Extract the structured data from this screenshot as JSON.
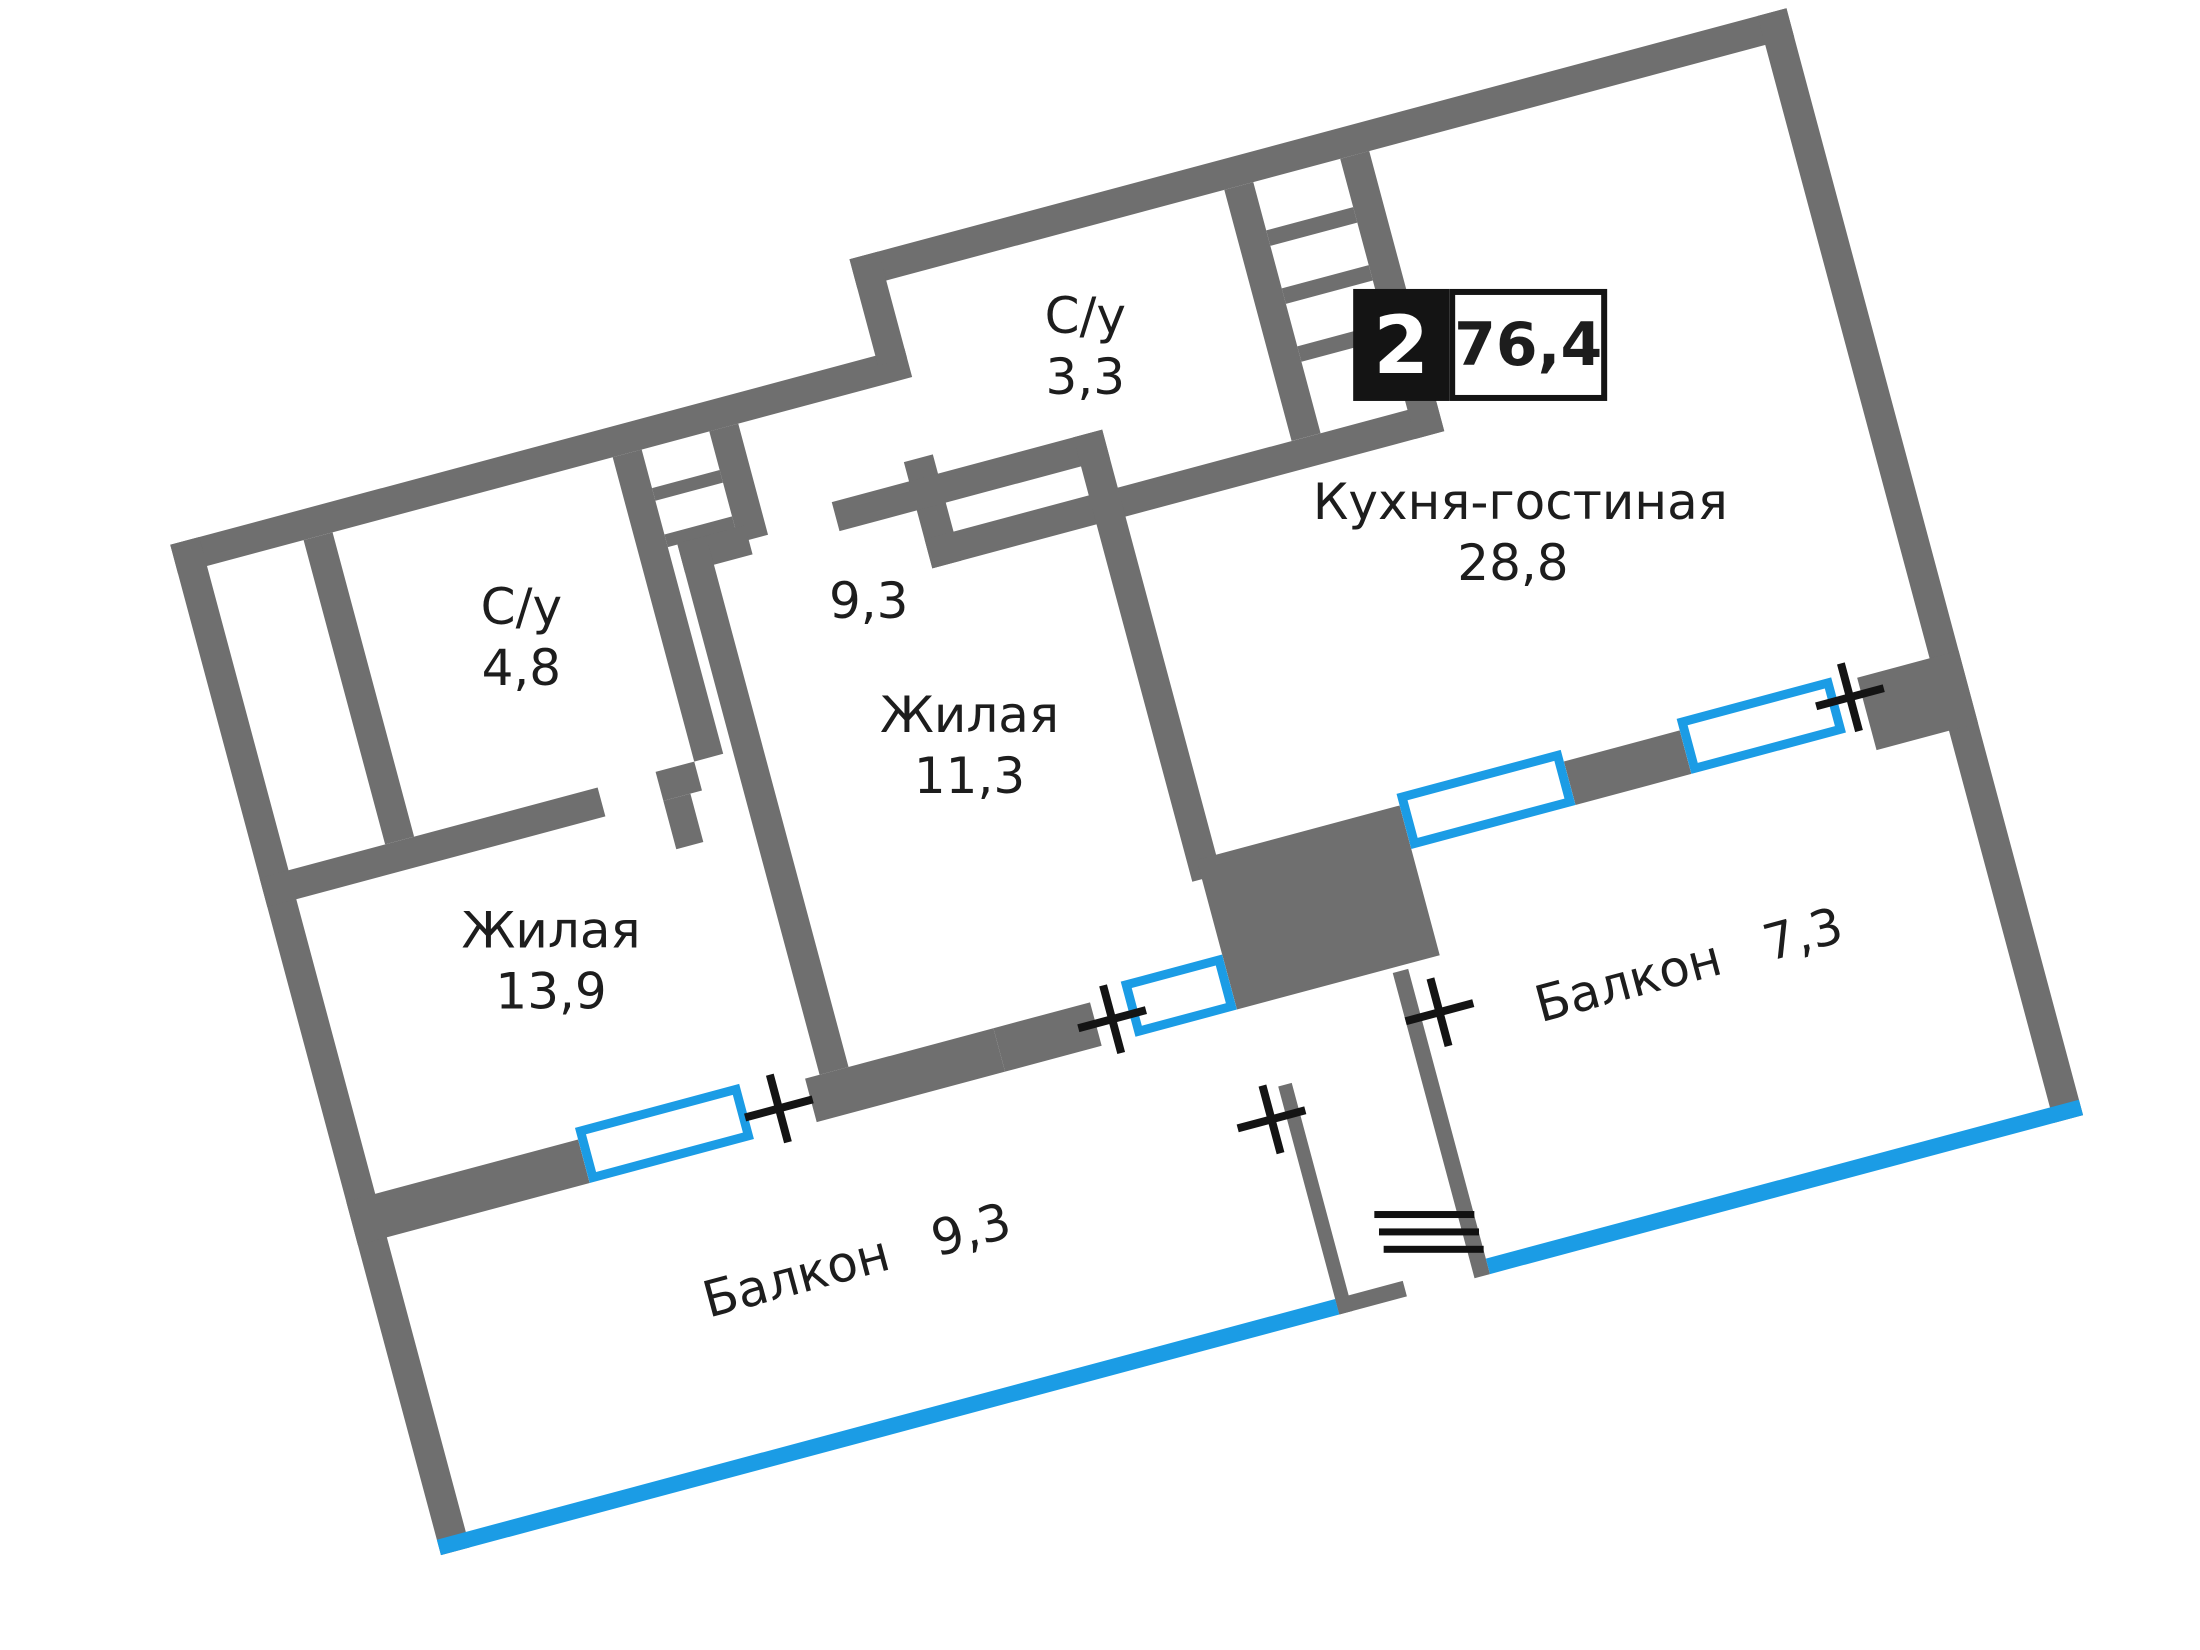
{
  "plan": {
    "badge": {
      "rooms_count": "2",
      "total_area": "76,4"
    },
    "rooms": {
      "bath1": {
        "name": "С/у",
        "area": "4,8"
      },
      "bath2": {
        "name": "С/у",
        "area": "3,3"
      },
      "hall": {
        "area": "9,3"
      },
      "kitchen": {
        "name": "Кухня-гостиная",
        "area": "28,8"
      },
      "living1": {
        "name": "Жилая",
        "area": "13,9"
      },
      "living2": {
        "name": "Жилая",
        "area": "11,3"
      },
      "balcony1": {
        "name": "Балкон",
        "area": "9,3"
      },
      "balcony2": {
        "name": "Балкон",
        "area": "7,3"
      }
    },
    "colors": {
      "wall": "#6f6f6f",
      "accent": "#1b9ce5",
      "text": "#1d1d1d"
    }
  }
}
